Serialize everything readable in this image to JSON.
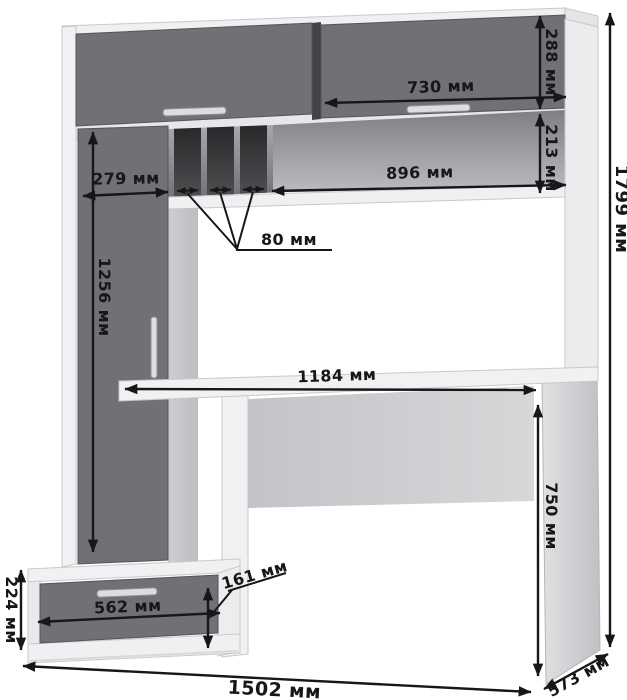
{
  "diagram": {
    "kind": "furniture-dimension-drawing",
    "unit": "мм"
  },
  "dimensions": {
    "overall_height": "1799 мм",
    "overall_width": "1502 мм",
    "desk_depth": "573 мм",
    "desk_height": "750 мм",
    "desktop_width": "1184 мм",
    "hutch_door_width": "730 мм",
    "hutch_door_height": "288 мм",
    "shelf_opening_height": "213 мм",
    "shelf_width": "896 мм",
    "left_column_width": "279 мм",
    "slot_width": "80 мм",
    "left_door_height": "1256 мм",
    "pedestal_height": "224 мм",
    "drawer_width": "562 мм",
    "drawer_front_height": "161 мм"
  },
  "colors": {
    "front_dark": "#717175",
    "carcass_light": "#f0f1f2",
    "dimension": "#17171a"
  }
}
